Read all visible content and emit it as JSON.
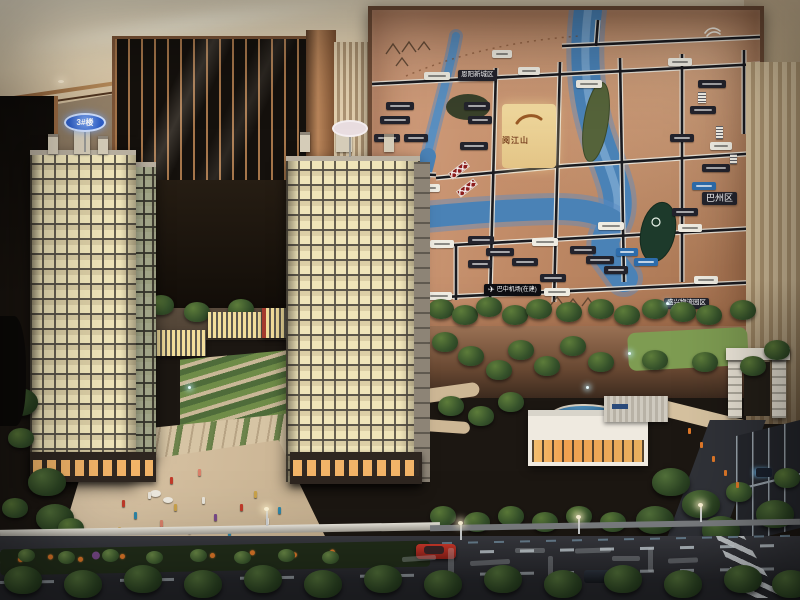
{
  "model": {
    "tower_sign": "3#楼"
  },
  "map": {
    "labels": {
      "new_town": "恩阳新城区",
      "district": "巴州区",
      "logistics_park": "盛兴物流园区",
      "airport": "巴中机场(在建)",
      "project_name": "阅江山"
    }
  },
  "icons": {
    "airplane": "✈"
  },
  "colors": {
    "map_bg": "#c08a66",
    "river_blue": "#4a82b6",
    "sign_blue": "#2f5fc8",
    "bridge_red": "#8c1d1d",
    "window_glow": "#f0e5ba",
    "copper": "#a5754a"
  }
}
